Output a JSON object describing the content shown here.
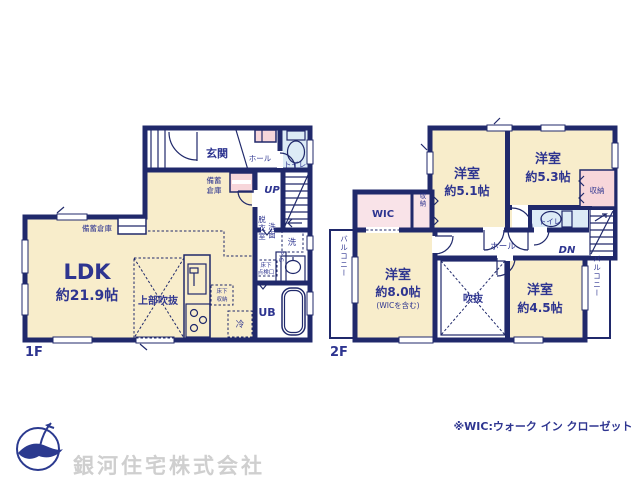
{
  "colors": {
    "wall": "#20296b",
    "ink": "#2e3590",
    "beige": "#f8edcb",
    "pink": "#f9e3e8",
    "closetpink": "#f7d6da",
    "blue": "#dcebf6",
    "gray": "#cfcfcf",
    "logo": "#2b3a8f",
    "paper": "#ffffff"
  },
  "floor1": {
    "floor_label": "1F",
    "rooms": {
      "genkan": "玄関",
      "hall": "ホール",
      "toilet": "トイレ",
      "up": "UP",
      "storage_upper_l1": "備蓄",
      "storage_upper_l2": "倉庫",
      "storage_left": "備蓄倉庫",
      "ldk_name": "LDK",
      "ldk_size": "約21.9帖",
      "open_above": "上部吹抜",
      "underfloor_storage_l1": "床下",
      "underfloor_storage_l2": "収納",
      "fridge": "冷",
      "dressing_room": "脱衣室",
      "washroom": "洗面",
      "washer": "洗",
      "pipe_space": "P.S",
      "underfloor_hatch_l1": "床下",
      "underfloor_hatch_l2": "点検口",
      "bath": "UB"
    }
  },
  "floor2": {
    "floor_label": "2F",
    "rooms": {
      "bedroom51_name": "洋室",
      "bedroom51_size": "約5.1帖",
      "bedroom53_name": "洋室",
      "bedroom53_size": "約5.3帖",
      "closet53": "収納",
      "wic": "WIC",
      "closet_wic": "収納",
      "toilet": "トイレ",
      "dn": "DN",
      "hall": "ホール",
      "balcony_left": "バルコニー",
      "bedroom80_name": "洋室",
      "bedroom80_size": "約8.0帖",
      "bedroom80_note": "(WICを含む)",
      "void": "吹抜",
      "bedroom45_name": "洋室",
      "bedroom45_size": "約4.5帖",
      "balcony_right": "バルコニー"
    }
  },
  "footer": {
    "wic_note": "※WIC:ウォーク イン クローゼット",
    "company": "銀河住宅株式会社"
  }
}
